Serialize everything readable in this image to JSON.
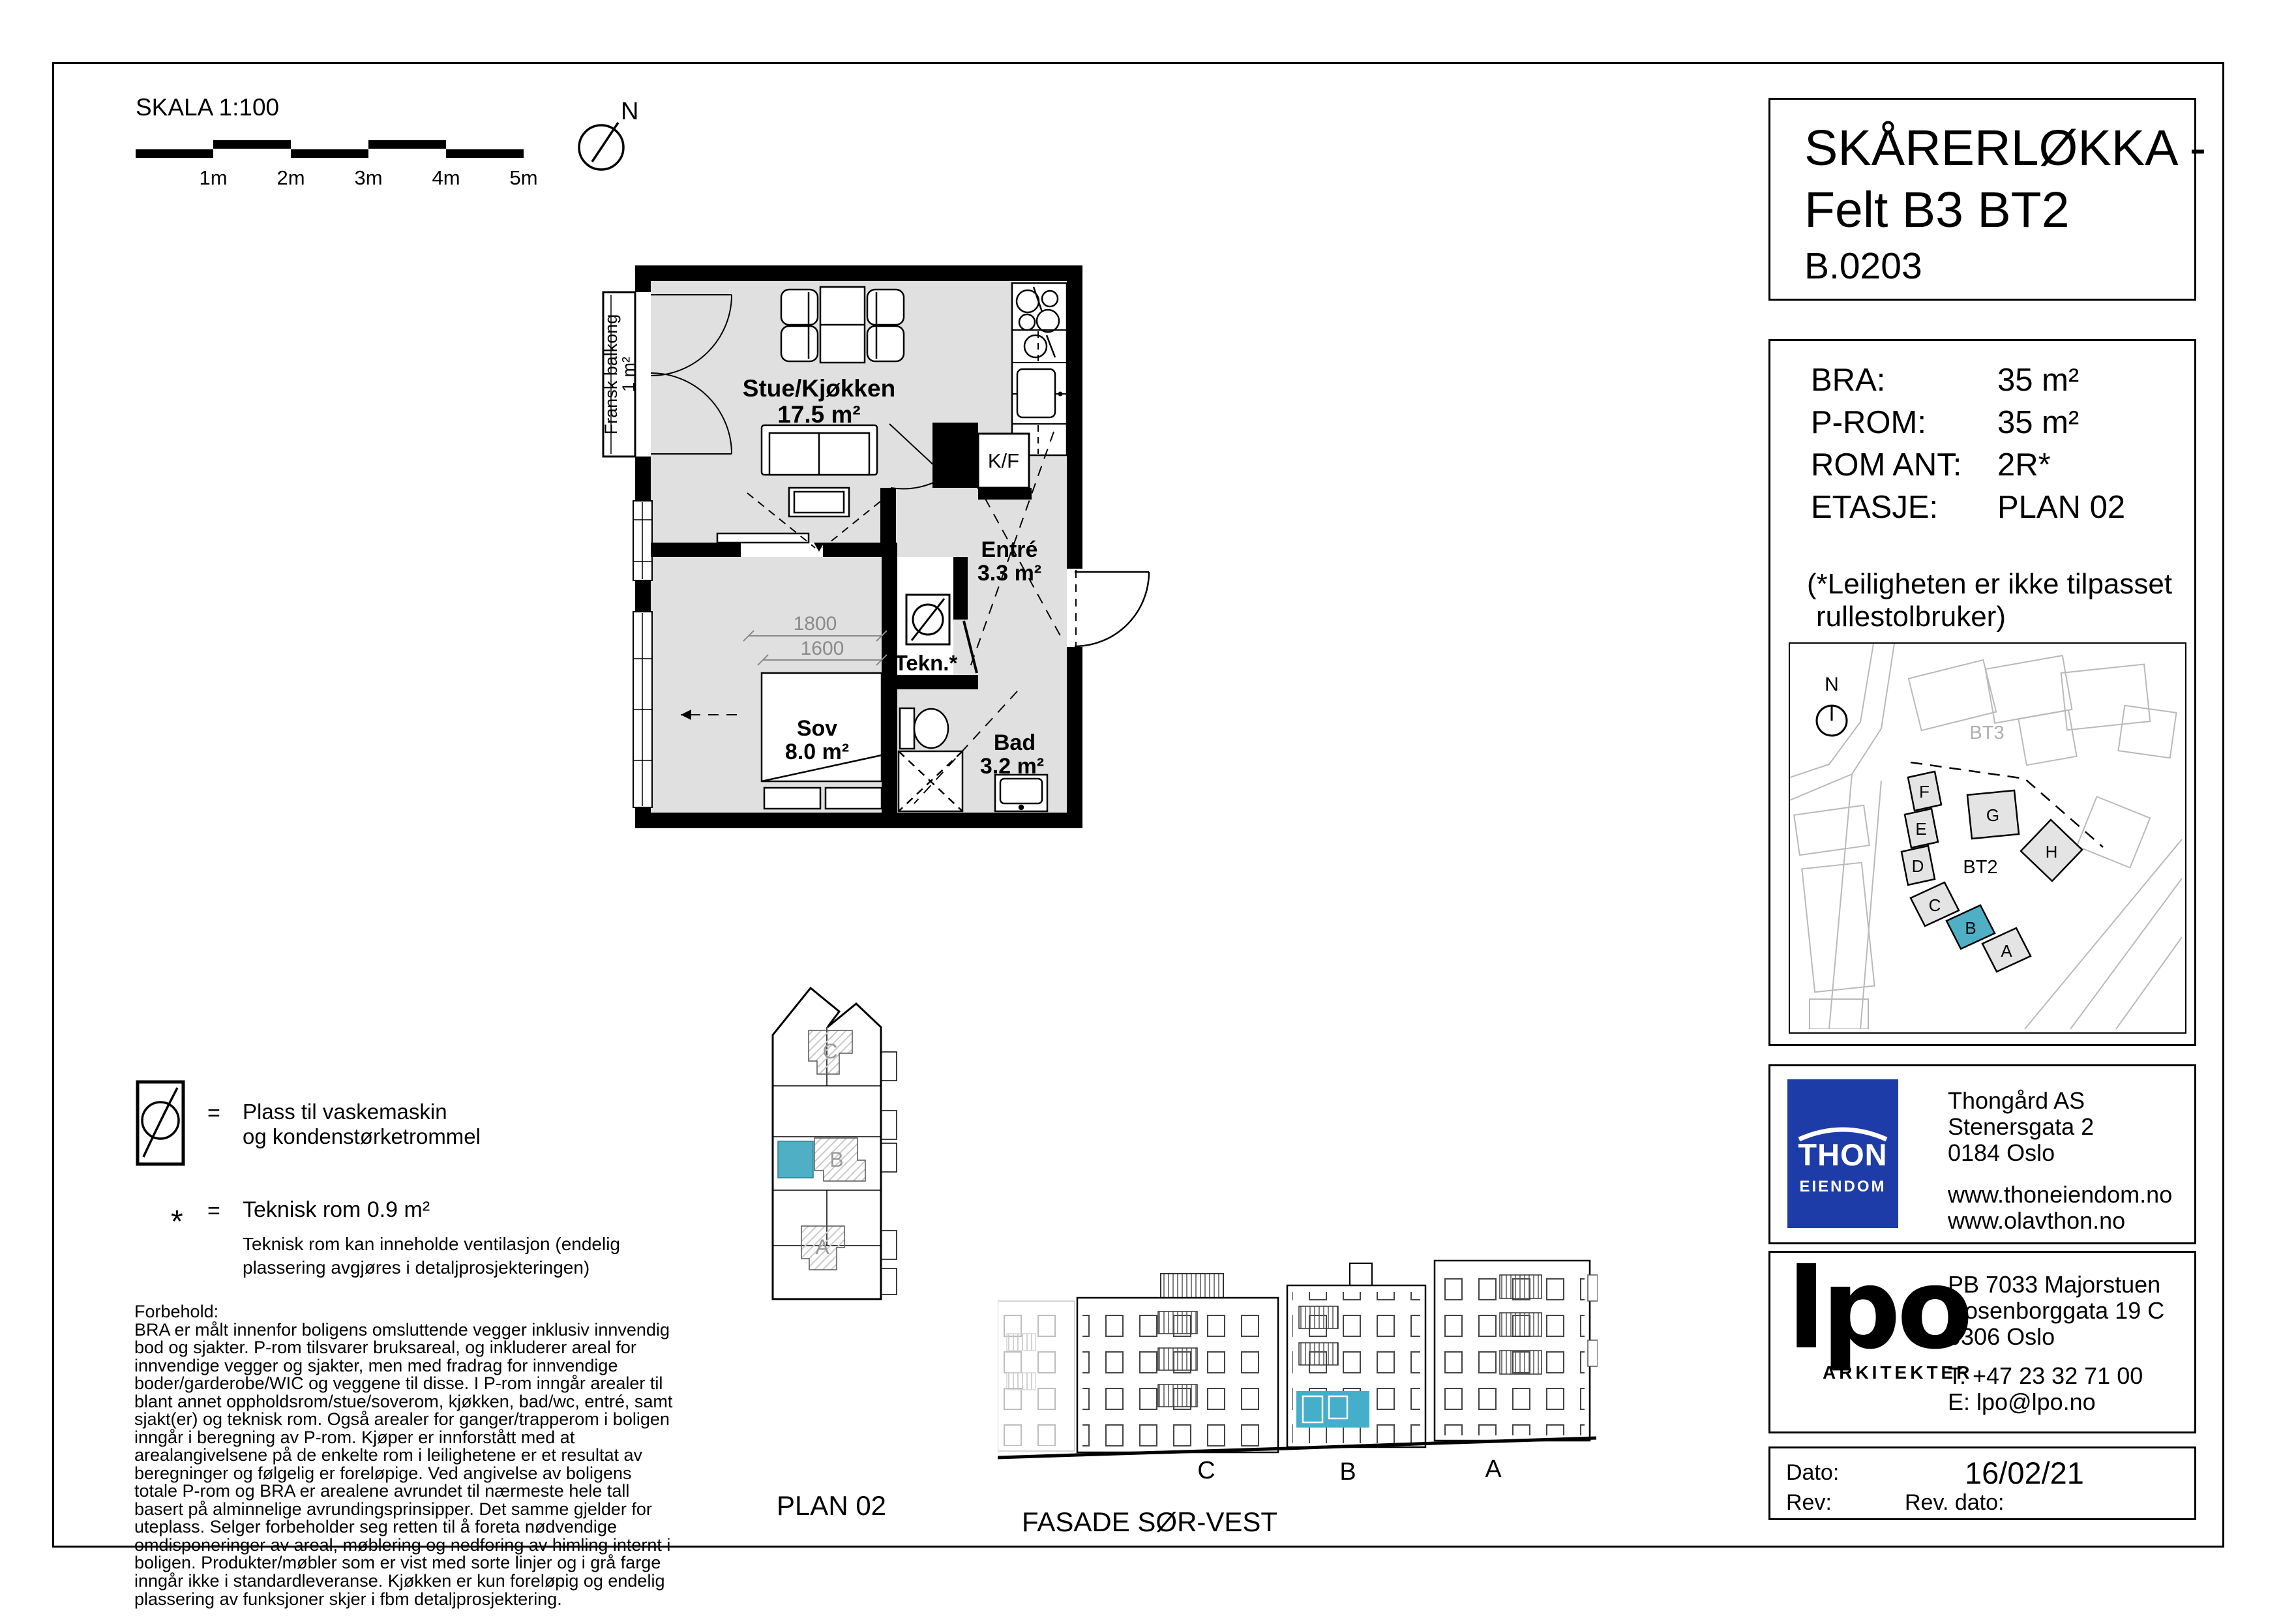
{
  "meta": {
    "skala": "SKALA 1:100",
    "ticks": [
      "1m",
      "2m",
      "3m",
      "4m",
      "5m"
    ],
    "north": "N"
  },
  "title_block": {
    "line1": "SKÅRERLØKKA -",
    "line2": "Felt B3 BT2",
    "unit": "B.0203"
  },
  "info": {
    "rows": [
      {
        "label": "BRA:",
        "value": "35 m²"
      },
      {
        "label": "P-ROM:",
        "value": "35 m²"
      },
      {
        "label": "ROM ANT:",
        "value": "2R*"
      },
      {
        "label": "ETASJE:",
        "value": "PLAN 02"
      }
    ],
    "note1": "(*Leiligheten er ikke tilpasset",
    "note2": "rullestolbruker)"
  },
  "site": {
    "north": "N",
    "bt3": "BT3",
    "bt2": "BT2",
    "letters": [
      "F",
      "E",
      "D",
      "C",
      "B",
      "A",
      "G",
      "H"
    ]
  },
  "plan": {
    "balcony1": "Fransk balkong",
    "balcony2": "1 m²",
    "stue_name": "Stue/Kjøkken",
    "stue_area": "17.5 m²",
    "entre_name": "Entré",
    "entre_area": "3.3 m²",
    "sov_name": "Sov",
    "sov_area": "8.0 m²",
    "bad_name": "Bad",
    "bad_area": "3.2 m²",
    "tekn": "Tekn.*",
    "kf": "K/F",
    "dim1": "1800",
    "dim2": "1600"
  },
  "legend": {
    "eq1": "=",
    "text1a": "Plass til vaskemaskin",
    "text1b": "og kondenstørketrommel",
    "star": "*",
    "eq2": "=",
    "text2": "Teknisk rom 0.9 m²",
    "text2b": "Teknisk rom kan inneholde ventilasjon (endelig",
    "text2c": "plassering avgjøres i detaljprosjekteringen)"
  },
  "forbehold": {
    "heading": "Forbehold:",
    "body": "BRA er målt innenfor boligens omsluttende vegger inklusiv innvendig bod og sjakter. P-rom tilsvarer bruksareal, og inkluderer areal for innvendige vegger og sjakter, men med fradrag for innvendige boder/garderobe/WIC og veggene til disse. I P-rom inngår arealer til blant annet oppholdsrom/stue/soverom, kjøkken, bad/wc, entré, samt sjakt(er) og teknisk rom. Også arealer for ganger/trapperom i boligen inngår i beregning av P-rom. Kjøper er innforstått med at arealangivelsene på de enkelte rom i leilighetene er et resultat av beregninger og følgelig er foreløpige. Ved angivelse av boligens totale P-rom og BRA er arealene avrundet til nærmeste hele tall basert på alminnelige avrundingsprinsipper. Det samme gjelder for uteplass. Selger forbeholder seg retten til å foreta nødvendige omdisponeringer av areal, møblering og nedforing av himling internt i boligen. Produkter/møbler som er vist med sorte linjer og i grå farge inngår ikke i standardleveranse. Kjøkken er kun foreløpig og endelig plassering av funksjoner skjer i fbm  detaljprosjektering."
  },
  "key_plan": {
    "label": "PLAN 02",
    "c": "C",
    "b": "B",
    "a": "A"
  },
  "facade": {
    "label": "FASADE SØR-VEST",
    "c": "C",
    "b": "B",
    "a": "A"
  },
  "thon": {
    "logo1": "THON",
    "logo2": "EIENDOM",
    "name": "Thongård AS",
    "addr1": "Stenersgata 2",
    "addr2": "0184 Oslo",
    "web1": "www.thoneiendom.no",
    "web2": "www.olavthon.no"
  },
  "lpo": {
    "logo": "lpo",
    "sub": "ARKITEKTER",
    "addr1": "PB 7033 Majorstuen",
    "addr2": "Rosenborggata 19 C",
    "addr3": "0306 Oslo",
    "phone": "T: +47 23 32 71 00",
    "email": "E: lpo@lpo.no"
  },
  "rev": {
    "dato_label": "Dato:",
    "dato": "16/02/21",
    "rev_label": "Rev:",
    "revdato_label": "Rev. dato:"
  },
  "colors": {
    "accent": "#4fb0c5",
    "thon_blue": "#1e3ca8"
  }
}
